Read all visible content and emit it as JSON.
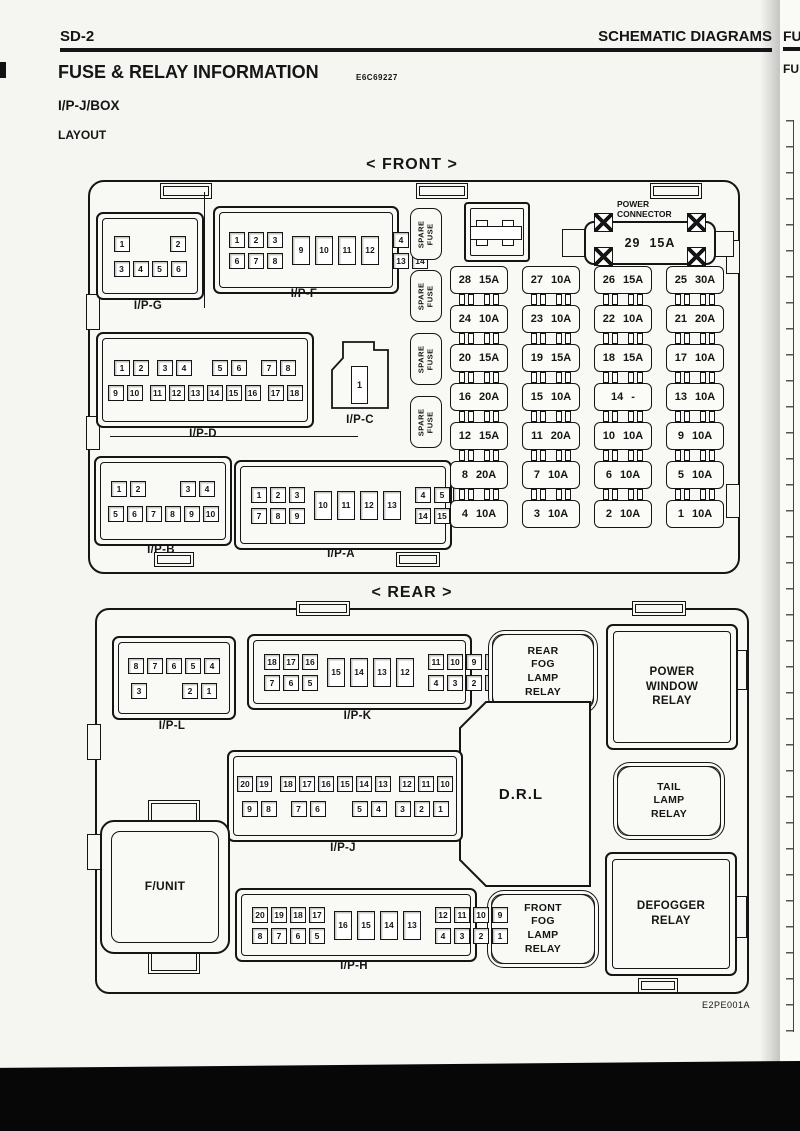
{
  "page": {
    "page_number": "SD-2",
    "header_right": "SCHEMATIC DIAGRAMS",
    "title": "FUSE  &  RELAY  INFORMATION",
    "title_code": "E6C69227",
    "subtitle": "I/P-J/BOX",
    "section_label": "LAYOUT",
    "figure_code": "E2PE001A",
    "next_page_edge_top": "FU",
    "next_page_edge_bottom": "FU"
  },
  "front": {
    "title": "< FRONT >",
    "spare_fuse_label": "SPARE\nFUSE",
    "power_connector": {
      "label": "POWER\nCONNECTOR",
      "value": "29  15A"
    },
    "connectors": {
      "ipg": {
        "label": "I/P-G",
        "row1": [
          "1",
          "2"
        ],
        "row2": [
          "3",
          "4",
          "5",
          "6"
        ]
      },
      "ipf": {
        "label": "I/P-F",
        "top_left": [
          "1",
          "2",
          "3"
        ],
        "bottom_left": [
          "6",
          "7",
          "8"
        ],
        "middle": [
          "9",
          "10",
          "11",
          "12"
        ],
        "top_right": [
          "4",
          "5"
        ],
        "bottom_right": [
          "13",
          "14"
        ]
      },
      "ipd": {
        "label": "I/P-D",
        "r1g1": [
          "1",
          "2"
        ],
        "r1g2": [
          "3",
          "4"
        ],
        "r1g3": [
          "5",
          "6"
        ],
        "r1g4": [
          "7",
          "8"
        ],
        "r2g1": [
          "9",
          "10"
        ],
        "r2g2": [
          "11",
          "12",
          "13",
          "14",
          "15",
          "16"
        ],
        "r2g3": [
          "17",
          "18"
        ]
      },
      "ipc": {
        "label": "I/P-C",
        "pin": "1"
      },
      "ipb": {
        "label": "I/P-B",
        "r1g1": [
          "1",
          "2"
        ],
        "r1g2": [
          "3",
          "4"
        ],
        "row2": [
          "5",
          "6",
          "7",
          "8",
          "9",
          "10"
        ]
      },
      "ipa": {
        "label": "I/P-A",
        "top_left": [
          "1",
          "2",
          "3"
        ],
        "bottom_left": [
          "7",
          "8",
          "9"
        ],
        "middle": [
          "10",
          "11",
          "12",
          "13"
        ],
        "top_right": [
          "4",
          "5",
          "6"
        ],
        "bottom_right": [
          "14",
          "15",
          "16"
        ]
      }
    },
    "fuse_columns": [
      [
        "28 15A",
        "24 10A",
        "20 15A",
        "16 20A",
        "12 15A",
        "8 20A",
        "4 10A"
      ],
      [
        "27 10A",
        "23 10A",
        "19 15A",
        "15 10A",
        "11 20A",
        "7 10A",
        "3 10A"
      ],
      [
        "26 15A",
        "22 10A",
        "18 15A",
        "14 -",
        "10 10A",
        "6 10A",
        "2 10A"
      ],
      [
        "25 30A",
        "21 20A",
        "17 10A",
        "13 10A",
        "9 10A",
        "5 10A",
        "1 10A"
      ]
    ]
  },
  "rear": {
    "title": "< REAR >",
    "drl_label": "D.R.L",
    "funit_label": "F/UNIT",
    "relays": {
      "rear_fog": "REAR\nFOG\nLAMP\nRELAY",
      "power_window": "POWER\nWINDOW\nRELAY",
      "tail": "TAIL\nLAMP\nRELAY",
      "defogger": "DEFOGGER\nRELAY",
      "front_fog": "FRONT\nFOG\nLAMP\nRELAY"
    },
    "connectors": {
      "ipl": {
        "label": "I/P-L",
        "row1": [
          "8",
          "7",
          "6",
          "5",
          "4"
        ],
        "r2g1": [
          "3"
        ],
        "r2g2": [
          "2",
          "1"
        ]
      },
      "ipk": {
        "label": "I/P-K",
        "top_left": [
          "18",
          "17",
          "16"
        ],
        "bottom_left": [
          "7",
          "6",
          "5"
        ],
        "middle": [
          "15",
          "14",
          "13",
          "12"
        ],
        "top_right": [
          "11",
          "10",
          "9",
          "8"
        ],
        "bottom_right": [
          "4",
          "3",
          "2",
          "1"
        ]
      },
      "ipj": {
        "label": "I/P-J",
        "r1g1": [
          "20",
          "19"
        ],
        "r1g2": [
          "18",
          "17",
          "16",
          "15",
          "14",
          "13"
        ],
        "r1g3": [
          "12",
          "11",
          "10"
        ],
        "r2g1": [
          "9",
          "8"
        ],
        "r2g2": [
          "7",
          "6"
        ],
        "r2g3": [
          "5",
          "4"
        ],
        "r2g4": [
          "3",
          "2",
          "1"
        ]
      },
      "iph": {
        "label": "I/P-H",
        "top_left": [
          "20",
          "19",
          "18",
          "17"
        ],
        "bottom_left": [
          "8",
          "7",
          "6",
          "5"
        ],
        "middle": [
          "16",
          "15",
          "14",
          "13"
        ],
        "top_right": [
          "12",
          "11",
          "10",
          "9"
        ],
        "bottom_right": [
          "4",
          "3",
          "2",
          "1"
        ]
      }
    }
  },
  "colors": {
    "ink": "#151515",
    "paper": "#f5f5f2",
    "scan_band": "#070707"
  }
}
